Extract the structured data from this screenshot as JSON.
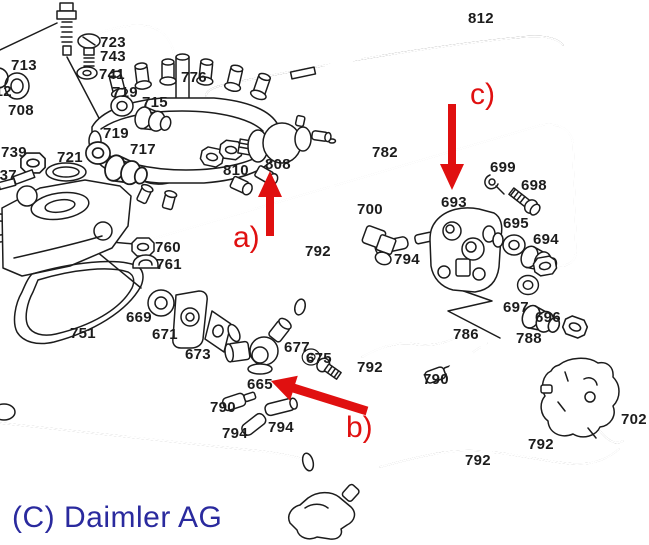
{
  "diagram": {
    "copyright": "(C) Daimler AG",
    "colors": {
      "line": "#1c1c1c",
      "arrow": "#e01010",
      "copyright": "#2a2a9e",
      "background": "#ffffff"
    },
    "part_labels": [
      {
        "text": "723",
        "x": 100,
        "y": 36
      },
      {
        "text": "743",
        "x": 100,
        "y": 50
      },
      {
        "text": "713",
        "x": 11,
        "y": 59
      },
      {
        "text": "741",
        "x": 99,
        "y": 68
      },
      {
        "text": "776",
        "x": 181,
        "y": 71
      },
      {
        "text": "719",
        "x": 112,
        "y": 86
      },
      {
        "text": "715",
        "x": 142,
        "y": 96
      },
      {
        "text": "708",
        "x": 8,
        "y": 104
      },
      {
        "text": "712",
        "x": -14,
        "y": 85
      },
      {
        "text": "719",
        "x": 103,
        "y": 127
      },
      {
        "text": "717",
        "x": 130,
        "y": 143
      },
      {
        "text": "739",
        "x": 1,
        "y": 146
      },
      {
        "text": "721",
        "x": 57,
        "y": 151
      },
      {
        "text": "737",
        "x": -9,
        "y": 169
      },
      {
        "text": "810",
        "x": 223,
        "y": 164
      },
      {
        "text": "808",
        "x": 265,
        "y": 158
      },
      {
        "text": "812",
        "x": 468,
        "y": 12
      },
      {
        "text": "782",
        "x": 372,
        "y": 146
      },
      {
        "text": "700",
        "x": 357,
        "y": 203
      },
      {
        "text": "693",
        "x": 441,
        "y": 196
      },
      {
        "text": "699",
        "x": 490,
        "y": 161
      },
      {
        "text": "698",
        "x": 521,
        "y": 179
      },
      {
        "text": "695",
        "x": 503,
        "y": 217
      },
      {
        "text": "694",
        "x": 533,
        "y": 233
      },
      {
        "text": "794",
        "x": 394,
        "y": 253
      },
      {
        "text": "792",
        "x": 305,
        "y": 245
      },
      {
        "text": "760",
        "x": 155,
        "y": 241
      },
      {
        "text": "761",
        "x": 156,
        "y": 258
      },
      {
        "text": "669",
        "x": 126,
        "y": 311
      },
      {
        "text": "671",
        "x": 152,
        "y": 328
      },
      {
        "text": "673",
        "x": 185,
        "y": 348
      },
      {
        "text": "751",
        "x": 70,
        "y": 327
      },
      {
        "text": "665",
        "x": 247,
        "y": 378
      },
      {
        "text": "677",
        "x": 284,
        "y": 341
      },
      {
        "text": "675",
        "x": 306,
        "y": 352
      },
      {
        "text": "697",
        "x": 503,
        "y": 301
      },
      {
        "text": "696",
        "x": 535,
        "y": 311
      },
      {
        "text": "786",
        "x": 453,
        "y": 328
      },
      {
        "text": "788",
        "x": 516,
        "y": 332
      },
      {
        "text": "790",
        "x": 210,
        "y": 401
      },
      {
        "text": "794",
        "x": 222,
        "y": 427
      },
      {
        "text": "794",
        "x": 268,
        "y": 421
      },
      {
        "text": "790",
        "x": 423,
        "y": 373
      },
      {
        "text": "792",
        "x": 357,
        "y": 361
      },
      {
        "text": "702",
        "x": 621,
        "y": 413
      },
      {
        "text": "792",
        "x": 528,
        "y": 438
      },
      {
        "text": "792",
        "x": 465,
        "y": 454
      }
    ],
    "annotations": [
      {
        "text": "a)",
        "x": 233,
        "y": 224
      },
      {
        "text": "b)",
        "x": 346,
        "y": 414
      },
      {
        "text": "c)",
        "x": 470,
        "y": 81
      }
    ]
  }
}
